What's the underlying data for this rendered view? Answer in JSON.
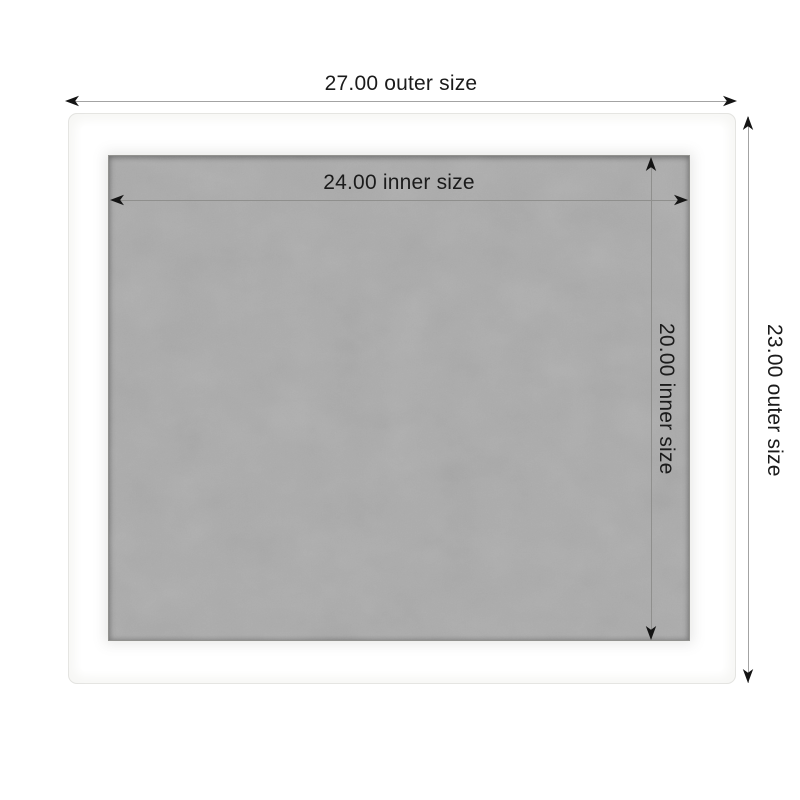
{
  "diagram": {
    "kind": "product-dimension-diagram",
    "product": "white frame with gray fabric board",
    "dimensions": {
      "outer_width": {
        "label": "27.00 outer size",
        "value": 27.0
      },
      "outer_height": {
        "label": "23.00 outer size",
        "value": 23.0
      },
      "inner_width": {
        "label": "24.00 inner size",
        "value": 24.0
      },
      "inner_height": {
        "label": "20.00 inner size",
        "value": 20.0
      }
    },
    "colors": {
      "background": "#ffffff",
      "frame": "#fcfcfa",
      "frame_border": "#e3e3e0",
      "fabric": "#ababab",
      "dimension_line": "#9a9a9a",
      "arrowhead": "#141414",
      "label_text": "#1b1b1b"
    },
    "icons": {
      "arrows": [
        "arrow-left-icon",
        "arrow-right-icon",
        "arrow-up-icon",
        "arrow-down-icon"
      ]
    }
  }
}
